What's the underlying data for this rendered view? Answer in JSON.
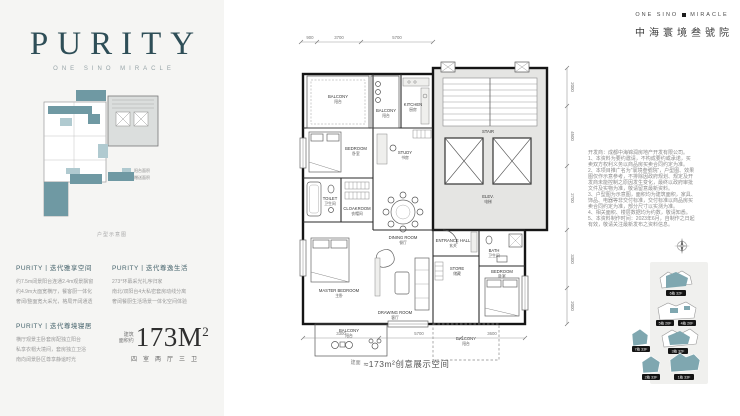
{
  "left": {
    "title": "PURITY",
    "subtitle": "ONE SINO MIRACLE",
    "mini": {
      "legend": [
        {
          "label": "阳台面积",
          "color": "#b0cad0"
        },
        {
          "label": "赠送面积",
          "color": "#6f99a3"
        }
      ],
      "caption": "户型示意图"
    },
    "sections": [
      {
        "heading": "PURITY丨迭代雅享空间",
        "lines": [
          "约7.5m阔景阳台连通2.4m观景飘窗",
          "约4.9m大面宽横厅，餐客厨一体化",
          "奢阔/整面宽大采光，格局开阔通透"
        ]
      },
      {
        "heading": "PURITY丨迭代尊逸生活",
        "lines": [
          "273°环幕采光礼序归家",
          "南北/双阳台4大私密套房动线分离",
          "奢阔餐厨生活场景一体化空间体验"
        ]
      },
      {
        "heading": "PURITY丨迭代尊境寝居",
        "lines": [
          "横厅观景主卧套房配独立阳台",
          "私享衣帽大境间，套房独立卫浴",
          "南向阔景卧区尊享静谧时光"
        ]
      }
    ],
    "area": {
      "prefix_lines": [
        "建筑",
        "面积约"
      ],
      "value": "173M",
      "sup": "2",
      "rooms": "四室两厅三卫"
    }
  },
  "plan": {
    "rooms": [
      {
        "en": "BALCONY",
        "cn": "阳台"
      },
      {
        "en": "BALCONY",
        "cn": "阳台"
      },
      {
        "en": "KITCHEN",
        "cn": "厨房"
      },
      {
        "en": "BEDROOM",
        "cn": "卧室"
      },
      {
        "en": "STUDY",
        "cn": "书房"
      },
      {
        "en": "TOILET",
        "cn": "卫生间"
      },
      {
        "en": "CLOAKROOM",
        "cn": "衣帽间"
      },
      {
        "en": "MASTER BEDROOM",
        "cn": "主卧"
      },
      {
        "en": "BALCONY",
        "cn": "阳台"
      },
      {
        "en": "DINING ROOM",
        "cn": "餐厅"
      },
      {
        "en": "DRAWING ROOM",
        "cn": "客厅"
      },
      {
        "en": "ENTRANCE HALL",
        "cn": "玄关"
      },
      {
        "en": "STORE",
        "cn": "储藏"
      },
      {
        "en": "BEDROOM",
        "cn": "卧室"
      },
      {
        "en": "BATH",
        "cn": "卫生间"
      },
      {
        "en": "BALCONY",
        "cn": "阳台"
      },
      {
        "en": "ELEV.",
        "cn": "电梯"
      },
      {
        "en": "STAIR",
        "cn": "楼梯"
      }
    ],
    "dims_top": [
      "900",
      "3700",
      "5700"
    ],
    "dims_right": [
      "2000",
      "4500",
      "2700",
      "3300",
      "2000"
    ],
    "dims_bottom": [
      "3300",
      "5700",
      "3600"
    ]
  },
  "caption": {
    "prefix": "建面",
    "text": "≈173m²创意展示空间"
  },
  "right": {
    "brand": {
      "en1": "ONE SINO",
      "en2": "MIRACLE",
      "cn": "中海寰境叁號院"
    },
    "disclaimer": [
      "开发商：成都中海锦润房地产开发有限公司。",
      "1、本资料为要约邀请，不构成要约或承诺，买",
      "卖双方权利义务以商品房买卖合同约定为准。",
      "2、本项目推广名为“寰境叁號院”，户型图、效果",
      "图仅作示意参考，不排除因政府规划、规定及开",
      "发商未能控制之原因发生变化，最终以政府审批",
      "文件及实物为准，敬请留意最新资料。",
      "3、户型图为示意图，面积均为建筑面积，家具、",
      "饰品、电器等非交付标准，交付标准以商品房买",
      "卖合同约定为准，部分尺寸以实测为准。",
      "4、相关面积、楼层数据均为约数，敬请知悉。",
      "5、本资料制作时间：2023年6月，自制作之日起",
      "有效，敬请关注最新发布之资料信息。"
    ],
    "site": {
      "labels": [
        "6栋 32F",
        "5栋 26F",
        "4栋 26F",
        "3栋 32F",
        "7栋 33F",
        "2栋 33F",
        "1栋 33F"
      ]
    }
  },
  "colors": {
    "panel_bg": "#f5f5f3",
    "title_teal": "#2e4e57",
    "teal_dark": "#6f99a3",
    "teal_light": "#b0cad0",
    "core_gray": "#e5e5e3",
    "site_teal": "#7fa7b0"
  }
}
